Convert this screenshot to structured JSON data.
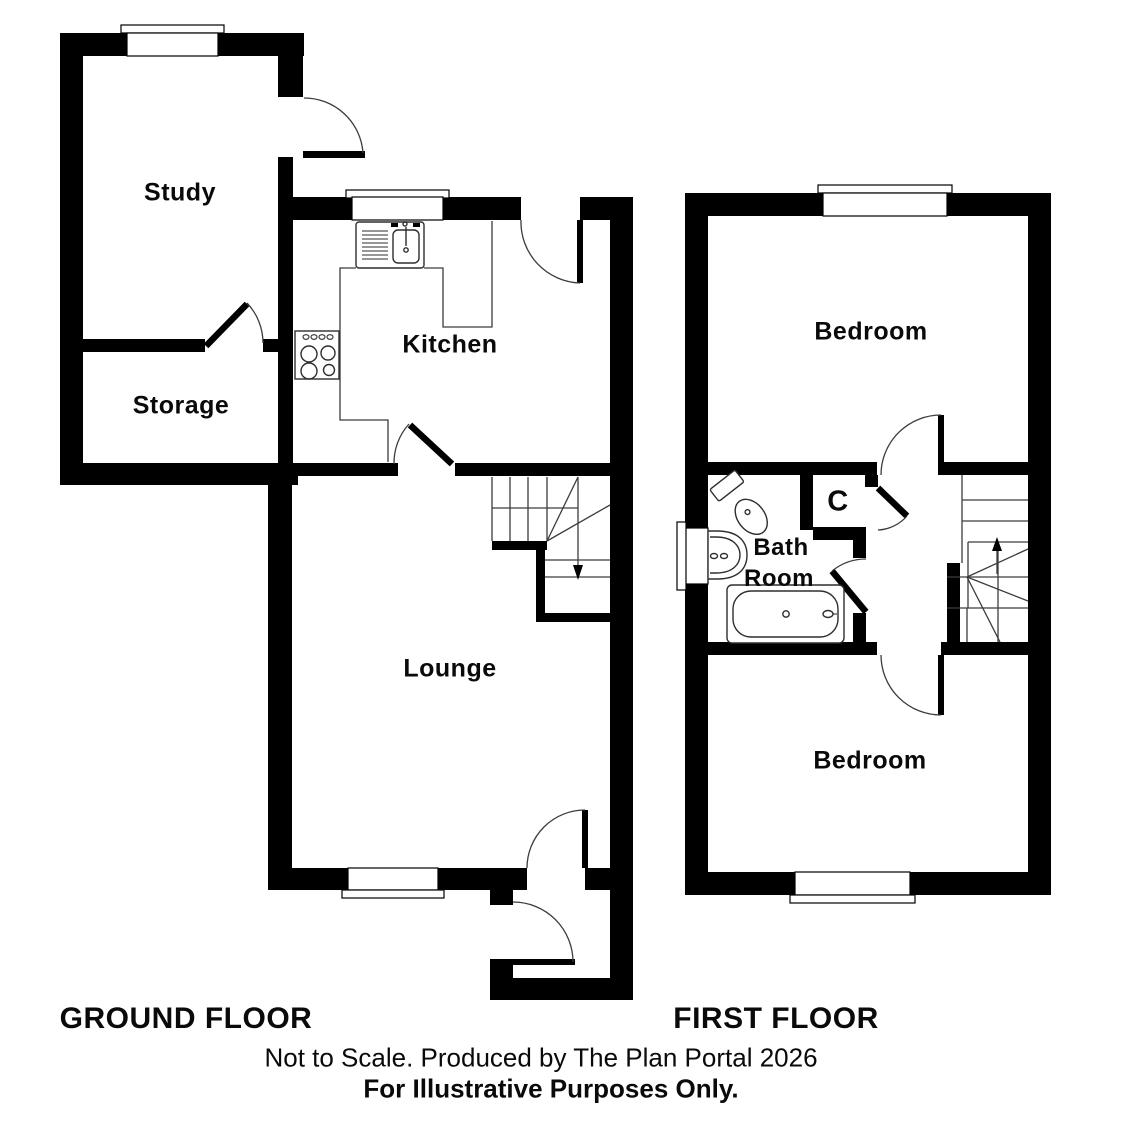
{
  "canvas": {
    "width": 1126,
    "height": 1129,
    "background_color": "#ffffff",
    "wall_color": "#000000",
    "detail_line_color": "#3c3c3c"
  },
  "ground_floor": {
    "title": "GROUND FLOOR",
    "rooms": {
      "study": "Study",
      "storage": "Storage",
      "kitchen": "Kitchen",
      "lounge": "Lounge"
    },
    "stairs_direction": "down"
  },
  "first_floor": {
    "title": "FIRST FLOOR",
    "rooms": {
      "bedroom_front": "Bedroom",
      "bathroom_line1": "Bath",
      "bathroom_line2": "Room",
      "cupboard": "C",
      "bedroom_back": "Bedroom"
    },
    "stairs_direction": "up"
  },
  "footer": {
    "note": "Not to Scale. Produced by The Plan Portal 2026",
    "disclaimer": "For Illustrative Purposes Only."
  }
}
